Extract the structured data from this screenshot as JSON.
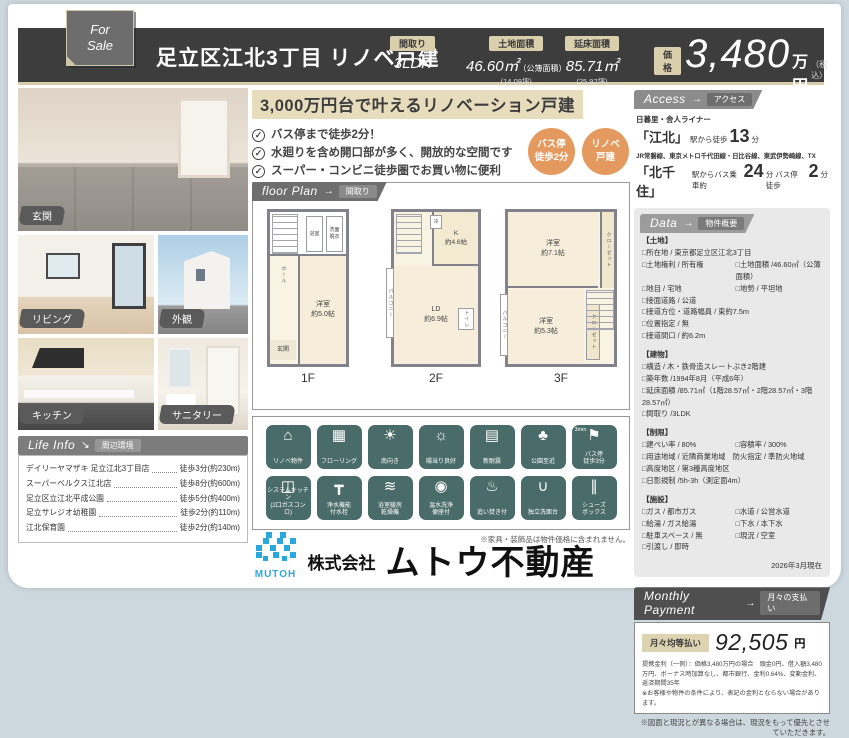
{
  "header": {
    "for_sale": "For\nSale",
    "title": "足立区江北3丁目 リノベ戸建",
    "specs": [
      {
        "label": "間取り",
        "value": "3LDK",
        "note": "",
        "tsubo": ""
      },
      {
        "label": "土地面積",
        "value": "46.60㎡",
        "note": "（公簿面積）",
        "tsubo": "(14.09坪)"
      },
      {
        "label": "延床面積",
        "value": "85.71㎡",
        "note": "",
        "tsubo": "(25.92坪)"
      }
    ],
    "price_label": "価格",
    "price_value": "3,480",
    "price_unit": "万円",
    "price_tax": "（税込）"
  },
  "photos": {
    "labels": [
      "玄関",
      "リビング",
      "外観",
      "キッチン",
      "サニタリー"
    ]
  },
  "catch": {
    "headline": "3,000万円台で叶えるリノベーション戸建",
    "bullets": [
      "バス停まで徒歩2分！",
      "水廻りを含め開口部が多く、開放的な空間です",
      "スーパー・コンビニ徒歩圏でお買い物に便利"
    ],
    "badges": [
      "バス停\n徒歩2分",
      "リノベ\n戸建"
    ]
  },
  "floor_plan": {
    "header_en": "floor Plan",
    "arrow": "→",
    "header_ja": "間取り",
    "floors": [
      {
        "label": "1F",
        "main": "洋室\n約5.0帖",
        "genkan": "玄関",
        "hall": "ホール",
        "u1": "浴室",
        "u2": "洗面\n脱衣"
      },
      {
        "label": "2F",
        "main": "LD\n約6.9帖",
        "kitchen": "K\n約4.6帖",
        "fridge": "冷",
        "wc": "トイレ",
        "balcony": "バルコニー"
      },
      {
        "label": "3F",
        "main": "洋室\n約7.1帖",
        "sub": "洋室\n約5.3帖",
        "closet1": "クローゼット",
        "closet2": "クローゼット",
        "balcony": "バルコニー"
      }
    ]
  },
  "features": {
    "bus_note": "3min",
    "rows": [
      [
        {
          "glyph": "⌂",
          "label": "リノベ物件"
        },
        {
          "glyph": "▦",
          "label": "フローリング"
        },
        {
          "glyph": "☀",
          "label": "南向き"
        },
        {
          "glyph": "☼",
          "label": "陽当り良好"
        },
        {
          "glyph": "▤",
          "label": "新耐震"
        },
        {
          "glyph": "♣",
          "label": "公園至近"
        },
        {
          "glyph": "⚑",
          "label": "バス停\n徒歩3分"
        }
      ],
      [
        {
          "glyph": "◫",
          "label": "システムキッチン\n(2口ガスコンロ)"
        },
        {
          "glyph": "┳",
          "label": "浄水機能\n付水栓"
        },
        {
          "glyph": "≋",
          "label": "浴室暖房\n乾燥機"
        },
        {
          "glyph": "◉",
          "label": "温水洗浄\n便座付"
        },
        {
          "glyph": "♨",
          "label": "追い焚き付"
        },
        {
          "glyph": "∪",
          "label": "独立洗面台"
        },
        {
          "glyph": "∥",
          "label": "シューズ\nボックス"
        }
      ]
    ]
  },
  "access": {
    "header_en": "Access",
    "arrow": "→",
    "header_ja": "アクセス",
    "line1": "日暮里・舎人ライナー",
    "sta1": "「江北」",
    "sta1_pre": "駅から徒歩",
    "sta1_min": "13",
    "sta1_unit": "分",
    "line2": "JR常磐線、東京メトロ千代田線・日比谷線、東武伊勢崎線、TX",
    "sta2": "「北千住」",
    "sta2_pre": "駅からバス乗車約",
    "sta2_min": "24",
    "sta2_mid": "分 バス停 徒歩",
    "sta2_min2": "2",
    "sta2_unit": "分"
  },
  "data_section": {
    "header_en": "Data",
    "arrow": "→",
    "header_ja": "物件概要",
    "land_title": "【土地】",
    "land": [
      {
        "l": "□所在地 / 東京都足立区江北3丁目",
        "r": ""
      },
      {
        "l": "□土地権利 / 所有権",
        "r": "□土地面積 /46.60㎡（公簿面積）"
      },
      {
        "l": "□地目 / 宅地",
        "r": "□地勢 / 平坦地"
      },
      {
        "l": "□接面道路 / 公道",
        "r": ""
      },
      {
        "l": "□接道方位・道路幅員 / 東約7.5m",
        "r": ""
      },
      {
        "l": "□位置指定 / 無",
        "r": ""
      },
      {
        "l": "□接道間口 / 約6.2m",
        "r": ""
      }
    ],
    "building_title": "【建物】",
    "building": [
      {
        "l": "□構造 / 木・鉄骨造スレートぶき2階建",
        "r": ""
      },
      {
        "l": "□築年数 /1994年8月（平成6年）",
        "r": ""
      },
      {
        "l": "□延床面積 /85.71㎡（1階28.57㎡・2階28.57㎡・3階28.57㎡）",
        "r": ""
      },
      {
        "l": "□間取り /3LDK",
        "r": ""
      }
    ],
    "limit_title": "【制限】",
    "limits": [
      {
        "l": "□建ぺい率 / 80%",
        "r": "□容積率 / 300%"
      },
      {
        "l": "□用途地域 / 近隣商業地域　防火指定 / 準防火地域",
        "r": ""
      },
      {
        "l": "□高度地区 / 第3種高度地区",
        "r": ""
      },
      {
        "l": "□日影規制 /5h-3h（測定面4m）",
        "r": ""
      }
    ],
    "facility_title": "【施設】",
    "facilities": [
      {
        "l": "□ガス / 都市ガス",
        "r": "□水道 / 公営水道"
      },
      {
        "l": "□給湯 / ガス給湯",
        "r": "□下水 / 本下水"
      },
      {
        "l": "□駐車スペース / 無",
        "r": "□現況 / 空室"
      },
      {
        "l": "□引渡し / 即時",
        "r": ""
      }
    ],
    "as_of": "2026年3月現在"
  },
  "life_info": {
    "header_en": "Life Info",
    "arrow": "↘",
    "header_ja": "周辺環境",
    "items": [
      {
        "name": "デイリーヤマザキ 足立江北3丁目店",
        "dist": "徒歩3分(約230m)"
      },
      {
        "name": "スーパーベルクス江北店",
        "dist": "徒歩8分(約600m)"
      },
      {
        "name": "足立区立江北平成公園",
        "dist": "徒歩5分(約400m)"
      },
      {
        "name": "足立サレジオ幼稚園",
        "dist": "徒歩2分(約110m)"
      },
      {
        "name": "江北保育園",
        "dist": "徒歩2分(約140m)"
      }
    ]
  },
  "monthly": {
    "header_en": "Monthly Payment",
    "arrow": "→",
    "header_ja": "月々の支払い",
    "label": "月々均等払い",
    "amount": "92,505",
    "unit": "円",
    "note": "提携金利（一例）：価格3,480万円の場合　頭金0円、借入額3,480万円、ボーナス時加算なし、都市銀行、金利0.64%、変動金利、返済期間35年\n※お客様や物件の条件により、表記の金利とならない場合があります。"
  },
  "disclaimers": {
    "furniture": "※家具・装飾品は物件価格に含まれません。",
    "drawing": "※図面と現況とが異なる場合は、現況をもって優先とさせていただきます。"
  },
  "footer": {
    "logo": "MUTOH",
    "company_prefix": "株式会社",
    "company_name": "ムトウ不動産"
  },
  "colors": {
    "accent_beige": "#d9cfac",
    "icon_teal": "#496b69",
    "badge_orange": "#e49a5f",
    "logo_blue": "#29a8e0",
    "header_dark": "#3d3d3d"
  }
}
